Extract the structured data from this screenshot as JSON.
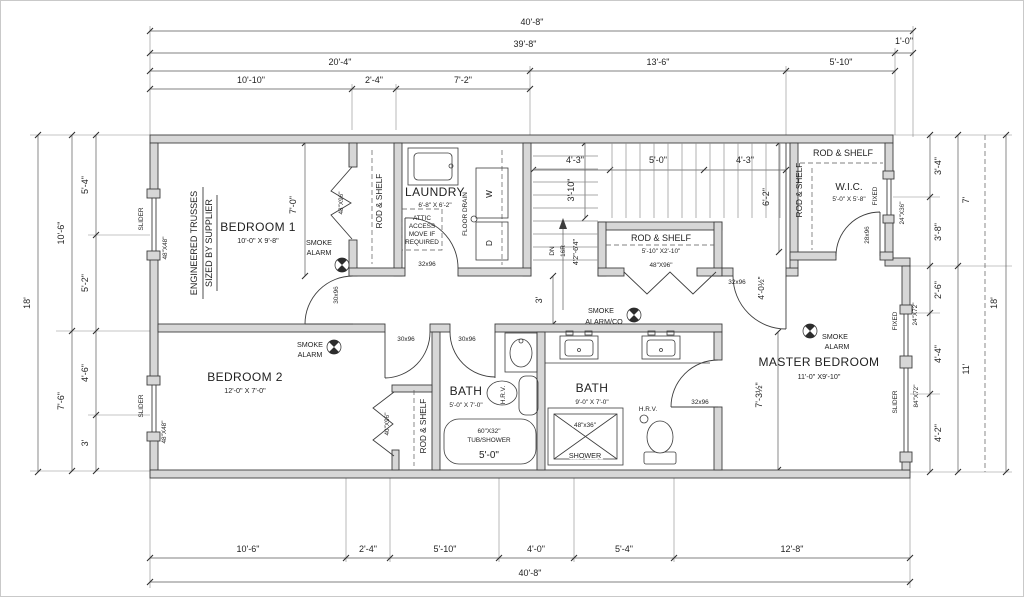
{
  "palette": {
    "paper": "#ffffff",
    "wall_fill": "#d7d7d7",
    "line": "#3d3d3d",
    "dim": "#5a5a5a"
  },
  "dims": {
    "top": [
      "40'-8\"",
      "39'-8\"",
      "1'-0\"",
      "20'-4\"",
      "13'-6\"",
      "5'-10\"",
      "10'-10\"",
      "2'-4\"",
      "7'-2\""
    ],
    "bottom": [
      "10'-6\"",
      "2'-4\"",
      "5'-10\"",
      "4'-0\"",
      "5'-4\"",
      "12'-8\"",
      "40'-8\""
    ],
    "left": [
      "18'",
      "10'-6\"",
      "7'-6\"",
      "5'-4\"",
      "5'-2\"",
      "4'-6\"",
      "3'"
    ],
    "right": [
      "3'-4\"",
      "3'-8\"",
      "2'-6\"",
      "4'-4\"",
      "4'-2\"",
      "7'",
      "11'",
      "18'"
    ],
    "interior": {
      "bedroom1_depth": "7'-0\"",
      "stair_left": "4'-3\"",
      "stair_mid": "5'-0\"",
      "stair_right": "4'-3\"",
      "stair_run": "3'-10\"",
      "wic_depth": "6'-2\"",
      "hall_width": "3'",
      "hall_door": "4'-0½\"",
      "master_side": "7'-3½\"",
      "down": "DN",
      "risers": "16R",
      "stair_note": "4'2\"-6'4\""
    }
  },
  "rooms": {
    "bedroom1": {
      "name": "BEDROOM 1",
      "size": "10'-0\" X 9'-8\""
    },
    "bedroom2": {
      "name": "BEDROOM 2",
      "size": "12'-0\" X 7'-0\""
    },
    "laundry": {
      "name": "LAUNDRY",
      "size": "6'-8\" X 6'-2\""
    },
    "bath1": {
      "name": "BATH",
      "size": "5'-0\" X 7'-0\""
    },
    "bath2": {
      "name": "BATH",
      "size": "9'-0\" X 7'-0\""
    },
    "master": {
      "name": "MASTER BEDROOM",
      "size": "11'-0\" X9'-10\""
    },
    "wic": {
      "name": "W.I.C.",
      "size": "5'-0\" X 5'-8\""
    }
  },
  "closets": {
    "rod_shelf": "ROD & SHELF",
    "hall_size": "5'-10\" X2'-10\""
  },
  "doors": {
    "d30": "30x96",
    "d32": "32x96",
    "d28": "28x96",
    "bifold48": "48\"X96\"",
    "bifold40": "40\"X96\""
  },
  "windows": {
    "slider": "SLIDER",
    "fixed": "FIXED",
    "w48": "48\"X48\"",
    "w24x36": "24\"X36\"",
    "w24x72": "24\"X72\"",
    "w84x72": "84\"X72\""
  },
  "notes": {
    "trusses_line1": "ENGINEERED TRUSSES",
    "trusses_line2": "SIZED BY SUPPLIER",
    "smoke": "SMOKE",
    "alarm": "ALARM",
    "alarm_co": "ALARM/CO",
    "attic_1": "ATTIC",
    "attic_2": "ACCESS",
    "attic_3": "MOVE IF",
    "attic_4": "REQUIRED",
    "floor_drain": "FLOOR DRAIN",
    "washer": "W",
    "dryer": "D",
    "hrv": "H.R.V.",
    "tub_size": "60\"X32\"",
    "tub_label": "TUB/SHOWER",
    "tub_width": "5'-0\"",
    "shower_size": "48\"x36\"",
    "shower_label": "SHOWER"
  }
}
